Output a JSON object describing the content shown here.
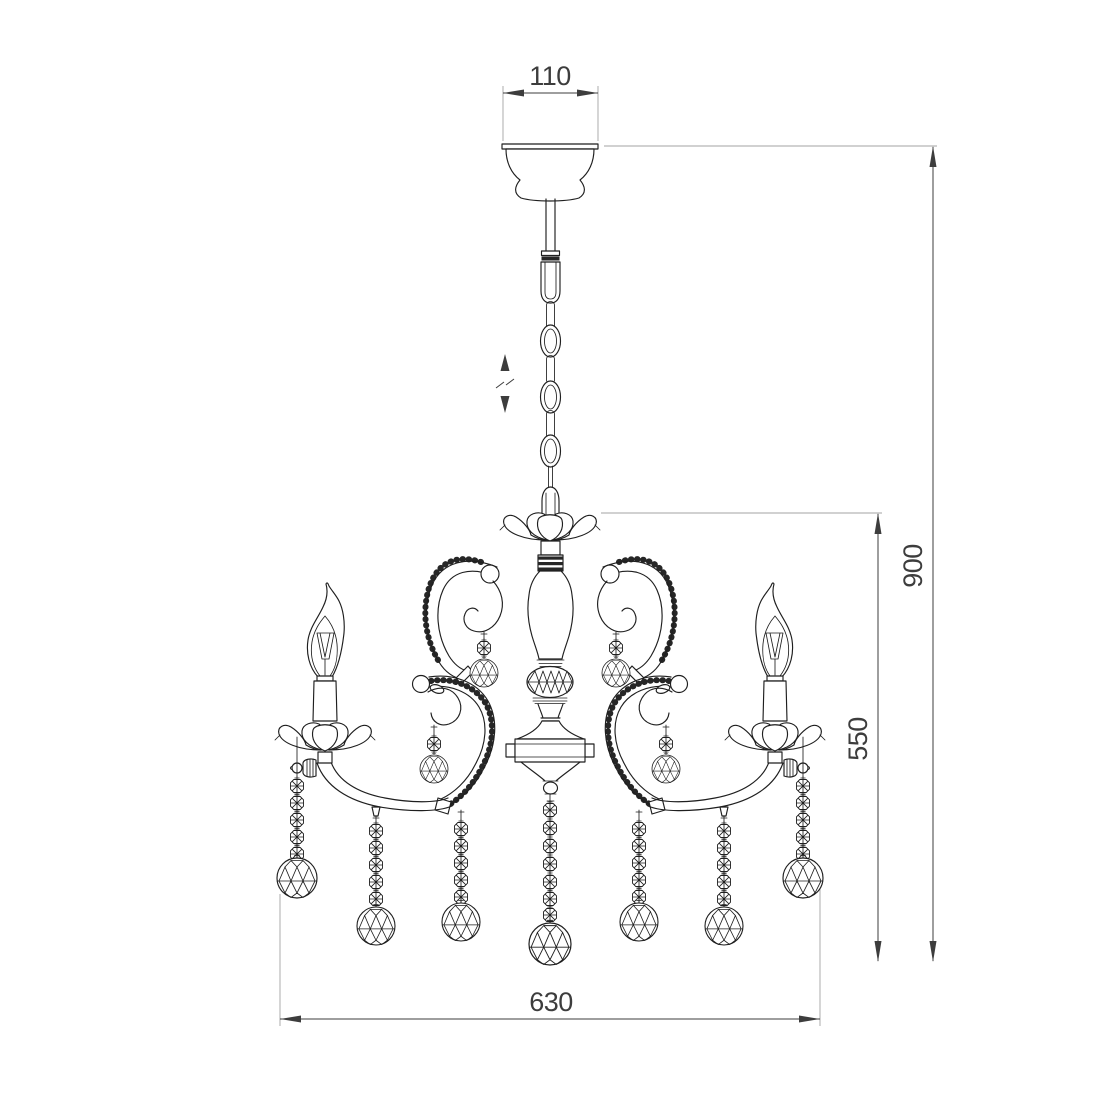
{
  "drawing": {
    "dimensions": {
      "canopy_width": "110",
      "overall_height": "900",
      "body_height": "550",
      "overall_width": "630"
    },
    "symbols": {
      "height_adjust_icon": "up-down arrows with break (adjustable suspension height)"
    },
    "colors": {
      "background": "#ffffff",
      "line": "#1f1f1f",
      "dimension": "#3d3d3d",
      "extension": "#a3a3a3",
      "bead_fill": "#262626"
    }
  }
}
